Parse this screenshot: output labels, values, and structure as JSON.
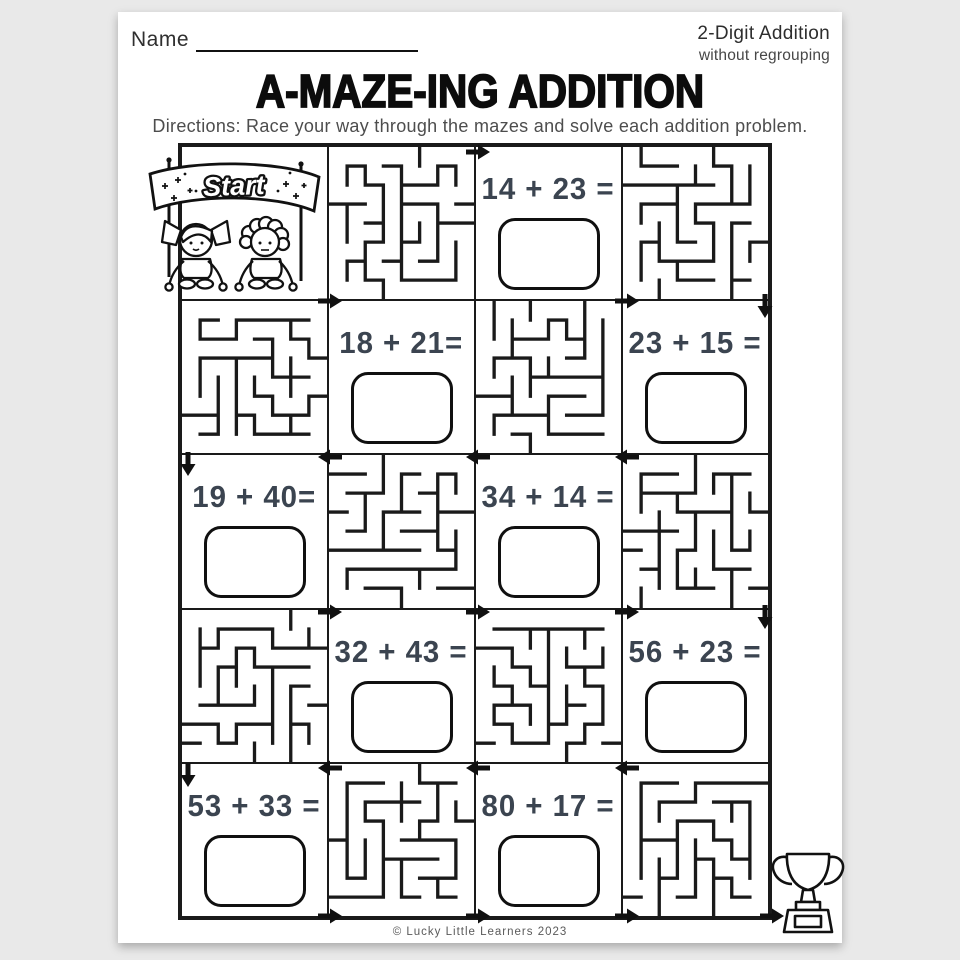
{
  "page": {
    "name_label": "Name",
    "corner_line1": "2-Digit Addition",
    "corner_line2": "without regrouping",
    "title": "A-MAZE-ING ADDITION",
    "directions": "Directions: Race your way through the mazes and solve each addition problem.",
    "start_banner": "Start",
    "footer": "© Lucky Little Learners 2023"
  },
  "colors": {
    "problem_text": "#3b4450",
    "line_black": "#1a1a1a",
    "page_background": "#e9e9e9",
    "gray_text": "#4d4d4d"
  },
  "grid": {
    "rows": 5,
    "cols": 4,
    "cells": [
      {
        "type": "start"
      },
      {
        "type": "maze"
      },
      {
        "type": "problem",
        "expr": "14 + 23 ="
      },
      {
        "type": "maze"
      },
      {
        "type": "maze"
      },
      {
        "type": "problem",
        "expr": "18 + 21="
      },
      {
        "type": "maze"
      },
      {
        "type": "problem",
        "expr": "23 + 15 ="
      },
      {
        "type": "problem",
        "expr": "19 + 40="
      },
      {
        "type": "maze"
      },
      {
        "type": "problem",
        "expr": "34 + 14 ="
      },
      {
        "type": "maze"
      },
      {
        "type": "maze"
      },
      {
        "type": "problem",
        "expr": "32 + 43 ="
      },
      {
        "type": "maze"
      },
      {
        "type": "problem",
        "expr": "56 + 23 ="
      },
      {
        "type": "problem",
        "expr": "53 + 33 ="
      },
      {
        "type": "maze"
      },
      {
        "type": "problem",
        "expr": "80 + 17 ="
      },
      {
        "type": "maze"
      }
    ]
  }
}
